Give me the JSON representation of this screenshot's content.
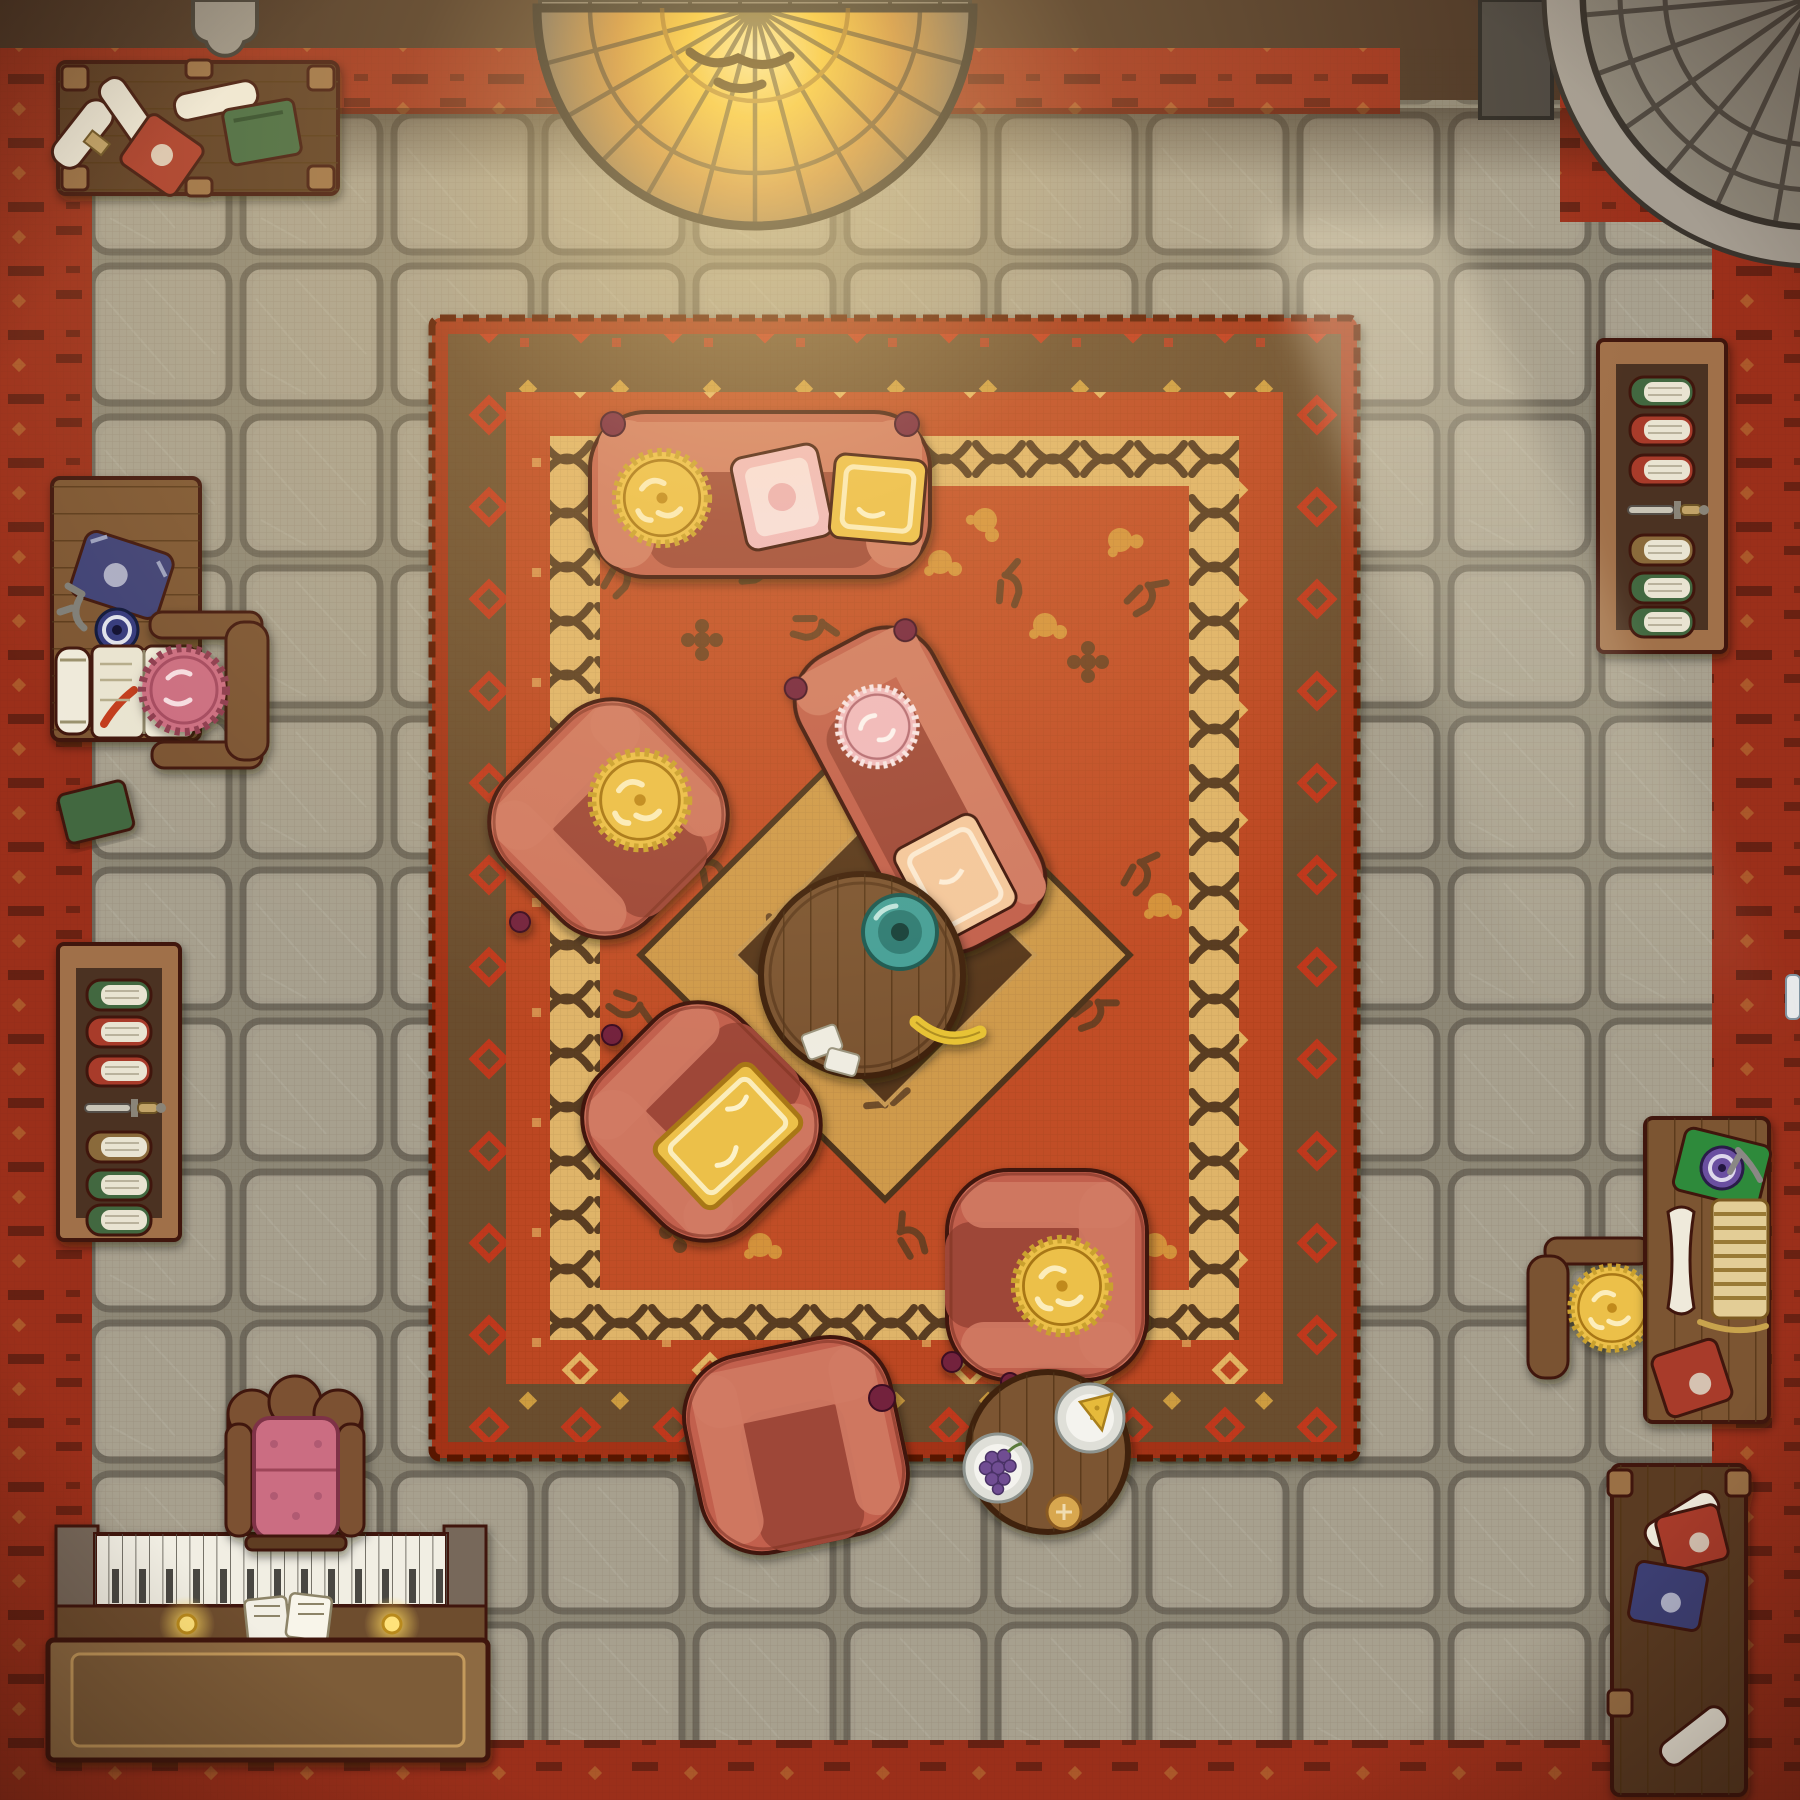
{
  "meta": {
    "kind": "top-down hand-drawn fantasy battlemap",
    "room": "cozy lounge / library with fireplace, piano and reading desks",
    "grid": {
      "tile_px": 150,
      "cols": 12,
      "rows": 12
    }
  },
  "palette": {
    "outline": "#40180e",
    "wall": "#4a3424",
    "wall_brick": "#7d7468",
    "border_red": "#9b2f1a",
    "border_glyph": "#3a140a",
    "border_gold": "#c08a3e",
    "floor": "#a49d8c",
    "floor_hi": "#aca593",
    "grout": "#6e685b",
    "floor_base": "#8d8776",
    "rug_edge": "#a33318",
    "band_brown": "#6b4e2f",
    "band_red": "#bc4721",
    "band_gold": "#dfb469",
    "rug_field": "#c14e25",
    "motif_gold": "#d9a441",
    "motif_dark": "#5e4023",
    "braid": "#5a3d20",
    "diamond_gold": "#cf9a4c",
    "diamond_dark": "#58391d",
    "sofa": "#c2604d",
    "sofa_hi": "#d07a64",
    "sofa_seat": "#9e4739",
    "knob": "#73213d",
    "cushion_gold": "#ecc04a",
    "cushion_gold_hi": "#f6db87",
    "cushion_pink": "#f0b9c0",
    "cushion_pink_hi": "#f8e0e4",
    "cushion_peach": "#f4c89e",
    "frill": "#caa12f",
    "wood": "#7c5531",
    "wood_dark": "#5a3b21",
    "wood_light": "#9a6f45",
    "plank": "#4e3014",
    "shelf_frame": "#a06f48",
    "shelf_bg": "#4c3320",
    "pages": "#e9e4d2",
    "book_green": "#42683f",
    "book_red": "#a83a2b",
    "book_blue": "#3e4076",
    "book_tan": "#8a6a3a",
    "scroll": "#efeadb",
    "blade": "#c9c4b6",
    "handle": "#c2a368",
    "plate": "#dfdfd8",
    "teal": "#44a098",
    "banana": "#e7c234",
    "grapes": "#6f4d92",
    "cheese": "#e6ba3a",
    "bun": "#d8a74f",
    "stone": "#8e8779",
    "stone_rim": "#a59d91",
    "stone_dark": "#39332c",
    "fire_core": "#fdf2ae",
    "fire_mid": "#f6c52e",
    "fire_deep": "#c98a36",
    "glow": "#ffdf8e",
    "candle": "#ffd95e",
    "piano_keys": "#f1eee3",
    "key_line": "#56524a",
    "chair_pink": "#cb6d82",
    "ink_blue": "#32377e",
    "ink_purple": "#6b4fa0",
    "plaque": "#9a948a"
  },
  "shelves": {
    "left": {
      "books": [
        "book_green",
        "book_red",
        "book_red",
        "dagger",
        "book_tan",
        "book_green",
        "book_green"
      ]
    },
    "right": {
      "books": [
        "book_green",
        "book_red",
        "book_red",
        "dagger",
        "book_tan",
        "book_green",
        "book_green"
      ]
    }
  },
  "scene": {
    "objects": [
      {
        "name": "fireplace",
        "desc": "semicircular stone hearth glowing with fire, top wall center"
      },
      {
        "name": "stone-staircase",
        "desc": "fan of curved stone steps with banister, top-right corner"
      },
      {
        "name": "wall-plaque",
        "desc": "grey shield plaque on top wall, left"
      },
      {
        "name": "side-table-top-left",
        "desc": "dark wooden table with three scrolls, red tome, green tome"
      },
      {
        "name": "writing-desk-left",
        "desc": "desk with blue tome, key, blue ink dish, rolled scroll, open book with red ribbon; chair with pink frilled cushion; green tome beside"
      },
      {
        "name": "bookshelf-left",
        "desc": "wooden shelf, six books and a dagger"
      },
      {
        "name": "bookshelf-right",
        "desc": "wooden shelf, six books and a dagger"
      },
      {
        "name": "grand-rug",
        "desc": "large red rug with brown and gold patterned borders and central diamond medallion"
      },
      {
        "name": "center-sofa",
        "desc": "red sofa with gold round cushion, pink pillow, gold pillow"
      },
      {
        "name": "chaise-sofa",
        "desc": "angled red chaise with pink round cushion and peach pillow"
      },
      {
        "name": "armchair-left",
        "desc": "red armchair, gold round cushion, rotated toward table"
      },
      {
        "name": "armchair-middle",
        "desc": "red armchair with gold rectangular cushion"
      },
      {
        "name": "armchair-right",
        "desc": "red armchair with gold round cushion facing left"
      },
      {
        "name": "armchair-bottom",
        "desc": "red armchair facing the snack table"
      },
      {
        "name": "coffee-table",
        "desc": "round plank table with teal dish, banana and napkins"
      },
      {
        "name": "snack-table",
        "desc": "round plank table with cheese plate, grape plate and bread roll"
      },
      {
        "name": "writing-desk-right",
        "desc": "desk with green tome, purple ink dish, quill, bone scroll, ledger stack, red tome; chair with gold cushion"
      },
      {
        "name": "side-table-bottom-right",
        "desc": "dark table with scrolls, red tome and blue tome"
      },
      {
        "name": "piano",
        "desc": "piano against bottom wall with sheet music and two lit candles"
      },
      {
        "name": "piano-throne",
        "desc": "ornate wooden chair with pink tufted cushion"
      }
    ]
  }
}
